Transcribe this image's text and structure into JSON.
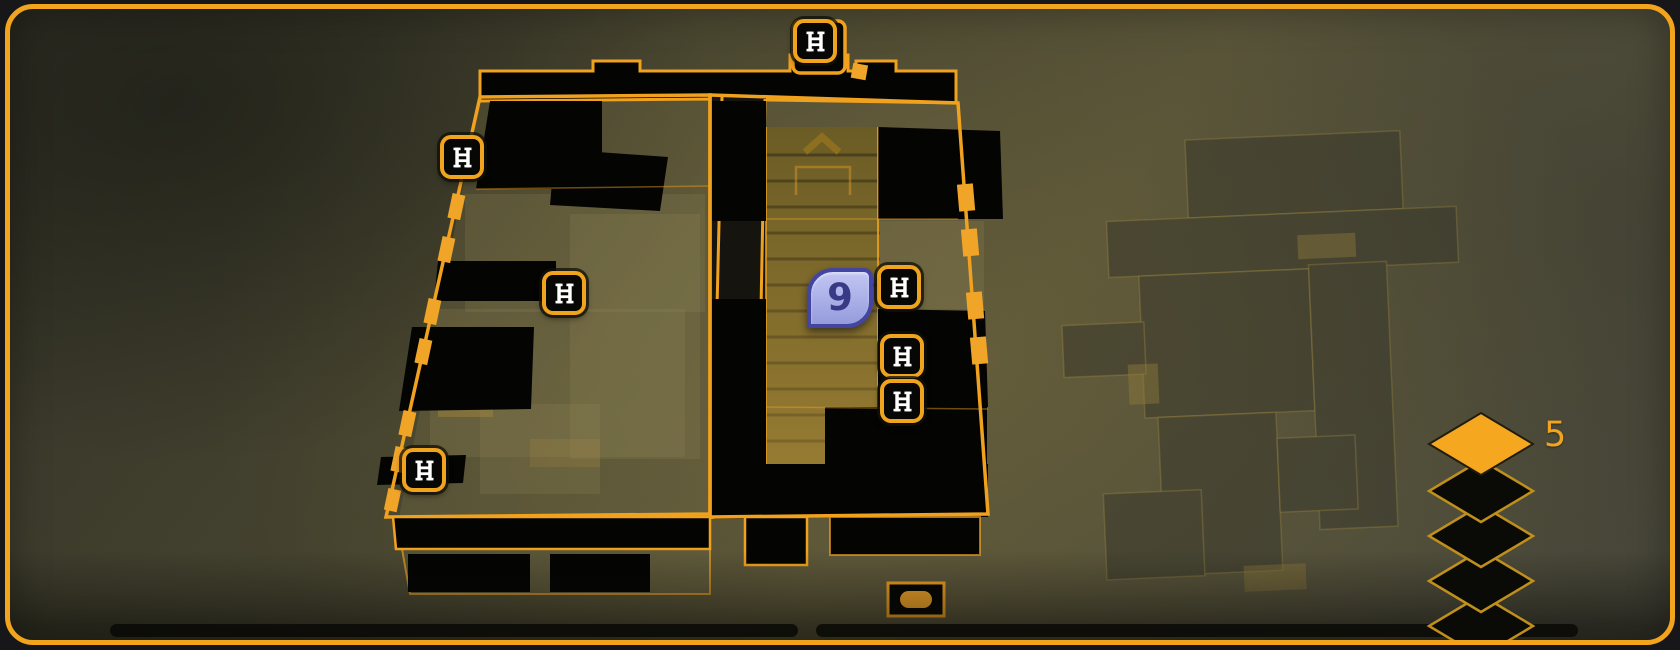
{
  "objective_marker": {
    "label": "9"
  },
  "floor_indicator": {
    "active_label": "5",
    "levels": [
      {
        "active": true
      },
      {
        "active": false
      },
      {
        "active": false
      },
      {
        "active": false
      },
      {
        "active": false
      }
    ]
  },
  "markers": {
    "ladders": [
      {
        "x": 805,
        "y": 32
      },
      {
        "x": 452,
        "y": 148
      },
      {
        "x": 554,
        "y": 284
      },
      {
        "x": 414,
        "y": 461
      },
      {
        "x": 889,
        "y": 278
      },
      {
        "x": 892,
        "y": 347
      },
      {
        "x": 892,
        "y": 392
      }
    ]
  },
  "icons": {
    "ladder": "ladder-icon",
    "stairs_up": "chevron-up-icon",
    "stairs_down": "chevron-down-icon",
    "floor_level": "diamond-icon",
    "elevator": "elevator-pill-icon"
  },
  "colors": {
    "accent_gold": "#F2A41D",
    "marker_fill": "#AEB3EA",
    "marker_border": "#4445A0",
    "room_fill": "#050503",
    "stair_fill": "#6B5C25"
  }
}
